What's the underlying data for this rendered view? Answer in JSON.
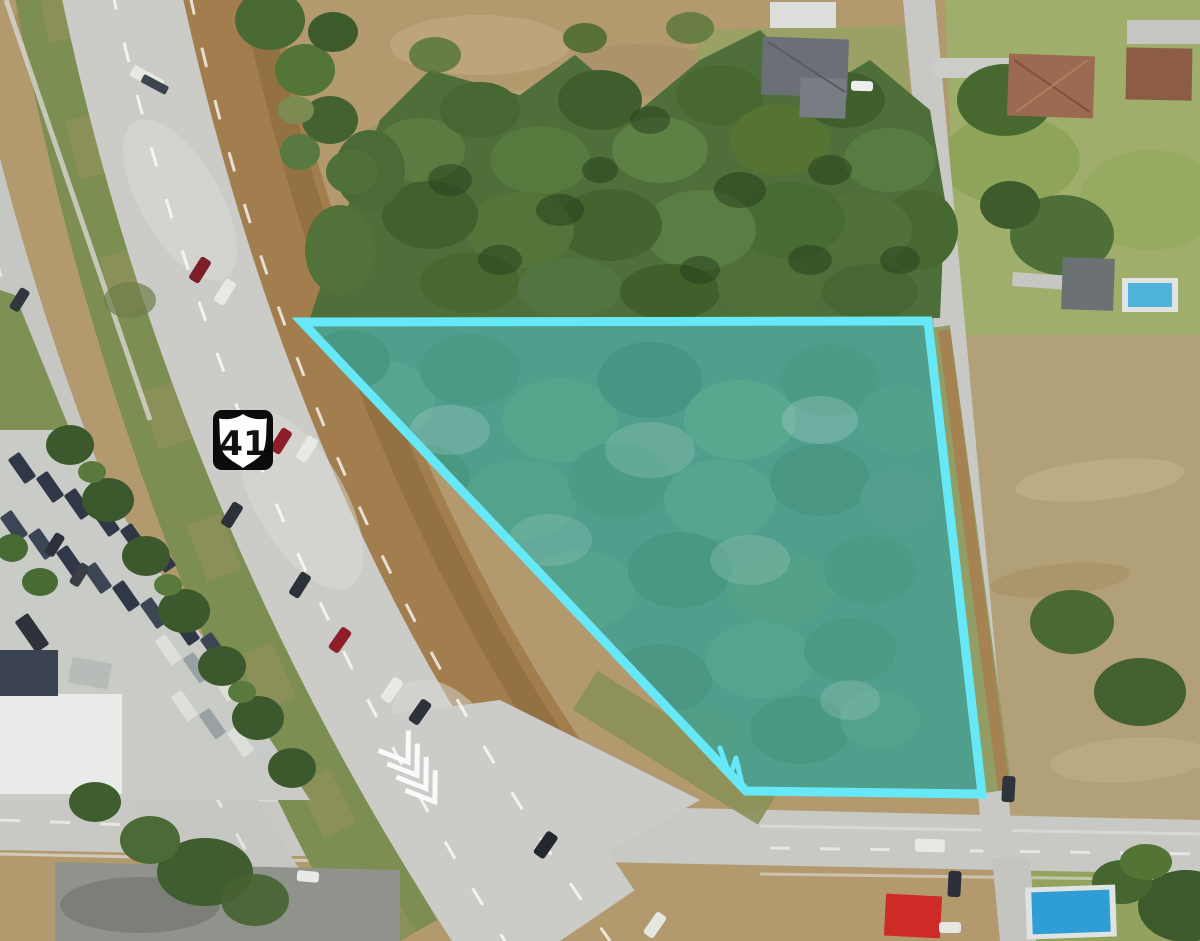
{
  "map": {
    "kind": "aerial-parcel-map",
    "route_shield": {
      "label": "41",
      "type": "us-route-shield"
    },
    "parcel": {
      "points": "302,322 928,321 982,794 746,791",
      "tick_points": "720,748 730,776 736,758 742,784",
      "outline_color": "#66E8F7",
      "fill_color": "rgba(82,214,232,0.45)"
    },
    "palette": {
      "pavement": "#CBCCC8",
      "median_grass": "#7D8E52",
      "shoulder_dirt": "#A27E4F",
      "tree_canopy": "#4E6E3A",
      "scrub_ground": "#B29A6E",
      "lawn": "#9FAE6B",
      "pool_water": "#4FB3DC",
      "bright_pool": "#2F9ED6",
      "red_canopy": "#CF2B26",
      "boat_cover": "#303848"
    }
  }
}
